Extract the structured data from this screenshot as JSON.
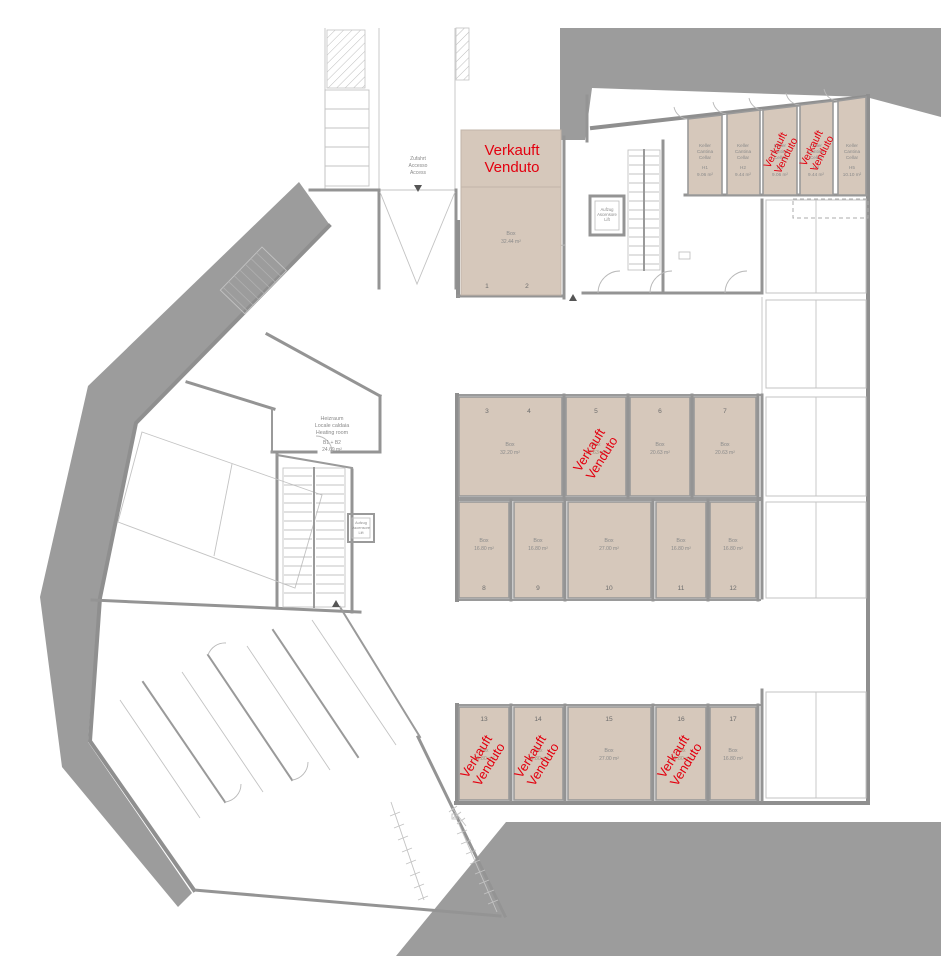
{
  "plan": {
    "colors": {
      "sold_red": "#e3000f",
      "unit_beige": "#d6c8bb",
      "exterior_gray": "#9c9c9c",
      "wall_gray": "#8f8f8f",
      "label_gray": "#8a8a8a"
    },
    "sold_label": {
      "line1": "Verkauft",
      "line2": "Venduto"
    },
    "access_label": {
      "line1": "Zufahrt",
      "line2": "Accesso",
      "line3": "Access"
    },
    "lift_label": {
      "line1": "Aufzug",
      "line2": "Ascensore",
      "line3": "Lift"
    },
    "heating_room": {
      "line1": "Heizraum",
      "line2": "Locale caldaia",
      "line3": "Heating room",
      "unit_id": "B1 + B2",
      "area": "24.69 m²"
    },
    "entry_box": {
      "label": "Box",
      "area": "32.44 m²",
      "space1": "1",
      "space2": "2"
    },
    "cellar_label": {
      "line1": "Keller",
      "line2": "Cantina",
      "line3": "Cellar"
    },
    "cellars": [
      {
        "id": "H1",
        "area": "9.06 m²",
        "status": "available"
      },
      {
        "id": "H2",
        "area": "9.44 m²",
        "status": "available"
      },
      {
        "id": "H3",
        "area": "9.06 m²",
        "status": "sold"
      },
      {
        "id": "H4",
        "area": "9.44 m²",
        "status": "sold"
      },
      {
        "id": "H5",
        "area": "10.10 m²",
        "status": "available"
      }
    ],
    "box_label": "Box",
    "boxes": [
      {
        "number": "3",
        "number2": "4",
        "area": "32.20 m²",
        "status": "available"
      },
      {
        "number": "5",
        "area": "20.63 m²",
        "status": "sold"
      },
      {
        "number": "6",
        "area": "20.63 m²",
        "status": "available"
      },
      {
        "number": "7",
        "area": "20.63 m²",
        "status": "available"
      },
      {
        "number": "8",
        "area": "16.80 m²",
        "status": "available"
      },
      {
        "number": "9",
        "area": "16.80 m²",
        "status": "available"
      },
      {
        "number": "10",
        "area": "27.00 m²",
        "status": "available"
      },
      {
        "number": "11",
        "area": "16.80 m²",
        "status": "available"
      },
      {
        "number": "12",
        "area": "16.80 m²",
        "status": "available"
      },
      {
        "number": "13",
        "area": "16.80 m²",
        "status": "sold"
      },
      {
        "number": "14",
        "area": "16.80 m²",
        "status": "sold"
      },
      {
        "number": "15",
        "area": "27.00 m²",
        "status": "available"
      },
      {
        "number": "16",
        "area": "16.80 m²",
        "status": "sold"
      },
      {
        "number": "17",
        "area": "16.80 m²",
        "status": "available"
      }
    ]
  }
}
